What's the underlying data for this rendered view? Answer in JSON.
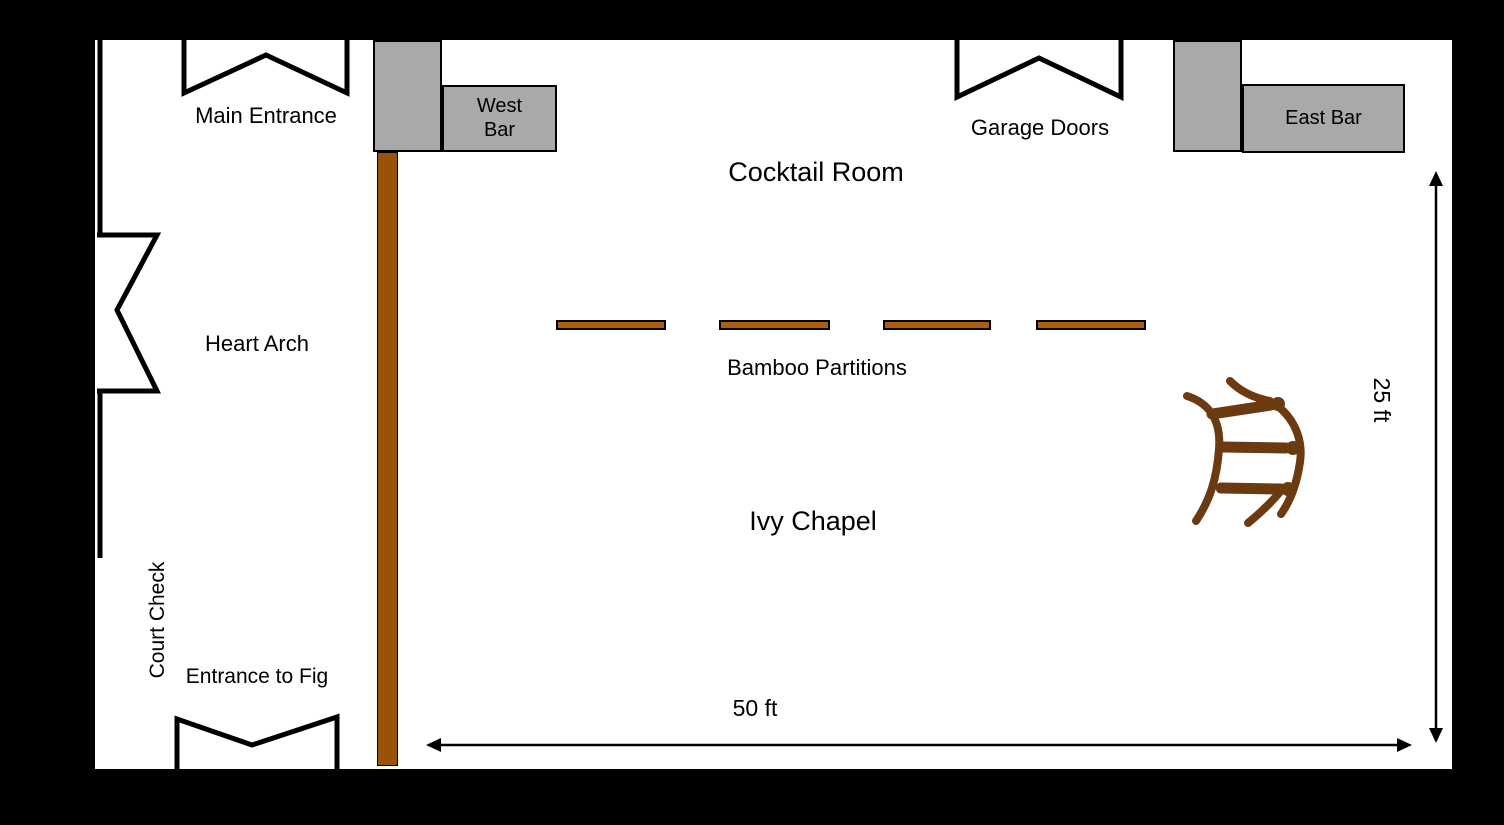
{
  "plan": {
    "areas": {
      "cocktail_room": "Cocktail Room",
      "ivy_chapel": "Ivy Chapel"
    },
    "entrances": {
      "main": "Main Entrance",
      "garage": "Garage Doors",
      "heart_arch": "Heart Arch",
      "fig": "Entrance to Fig"
    },
    "features": {
      "west_bar": "West Bar",
      "east_bar": "East Bar",
      "bamboo_partitions": "Bamboo Partitions",
      "court_check": "Court Check"
    },
    "dimensions": {
      "width": "50 ft",
      "height": "25 ft"
    },
    "colors": {
      "background": "#000000",
      "floor": "#ffffff",
      "line": "#000000",
      "wall_brown": "#9a5208",
      "bamboo_brown": "#b05c12",
      "sketch_brown": "#6b3a10",
      "bar_gray": "#a9a9a9"
    }
  }
}
